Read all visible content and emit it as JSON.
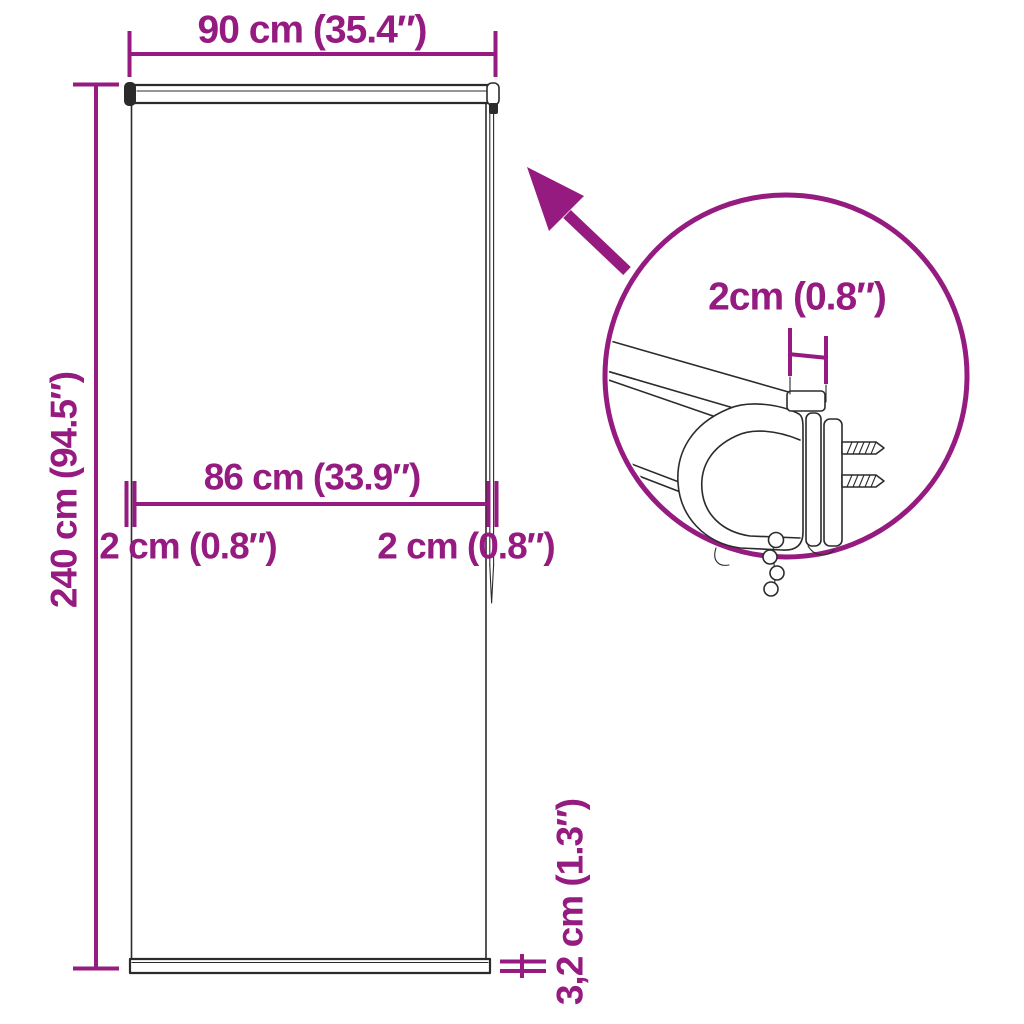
{
  "diagram": {
    "colors": {
      "accent": "#951b81",
      "line": "#2b2b2b",
      "background": "#ffffff"
    },
    "dimensions": {
      "total_width": "90 cm (35.4″)",
      "total_height": "240 cm (94.5″)",
      "fabric_width": "86 cm (33.9″)",
      "left_offset": "2 cm (0.8″)",
      "right_offset": "2 cm (0.8″)",
      "bottom_bar_height": "3,2 cm (1.3″)",
      "bracket_depth": "2cm (0.8″)"
    }
  }
}
